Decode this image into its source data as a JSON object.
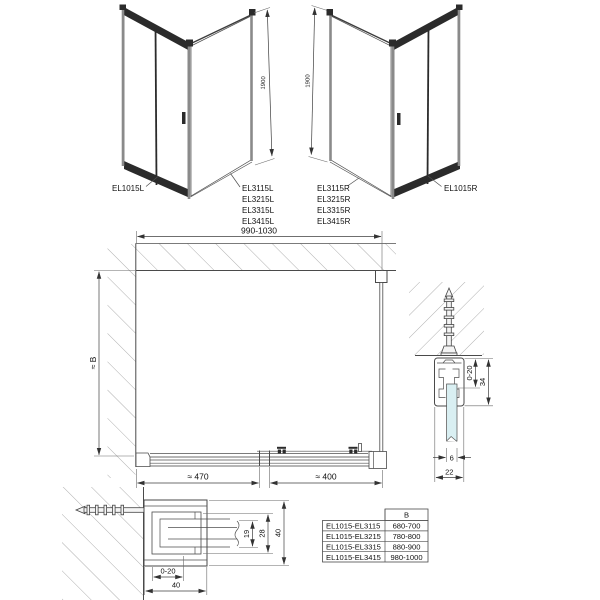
{
  "iso_left": {
    "door_label": "EL1015L",
    "panel_labels": [
      "EL3115L",
      "EL3215L",
      "EL3315L",
      "EL3415L"
    ],
    "height_dim": "1900"
  },
  "iso_right": {
    "door_label": "EL1015R",
    "panel_labels": [
      "EL3115R",
      "EL3215R",
      "EL3315R",
      "EL3415R"
    ],
    "height_dim": "1900"
  },
  "front_view": {
    "width_dim": "990-1030",
    "height_dim": "≈ B",
    "fixed_part_dim": "≈ 470",
    "door_part_dim": "≈ 400"
  },
  "wall_profile_section": {
    "adjustment_dim": "0-20",
    "depth_dim": "34",
    "glass_thickness_dim": "6",
    "profile_width_dim": "22"
  },
  "wall_profile_plan": {
    "adjustment_dim": "0-20",
    "bottom_width_dim": "40",
    "inner_dim": "19",
    "middle_dim": "28",
    "outer_dim": "40"
  },
  "size_table": {
    "column_header": "B",
    "rows": [
      {
        "combination": "EL1015-EL3115",
        "width_b": "680-700"
      },
      {
        "combination": "EL1015-EL3215",
        "width_b": "780-800"
      },
      {
        "combination": "EL1015-EL3315",
        "width_b": "880-900"
      },
      {
        "combination": "EL1015-EL3415",
        "width_b": "980-1000"
      }
    ]
  },
  "colors": {
    "glass_front": "#dff2f4",
    "glass_side": "#d2ecef",
    "line": "#4a4a4a",
    "hatch": "#9b9b9b"
  }
}
